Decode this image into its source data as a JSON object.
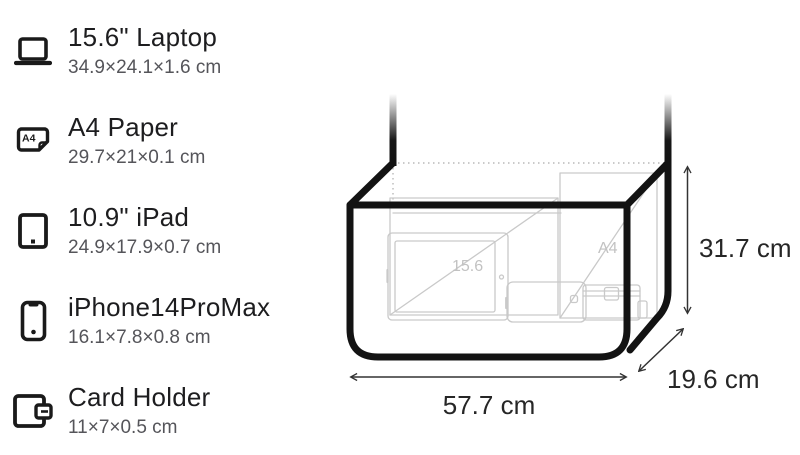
{
  "items": [
    {
      "name": "15.6\" Laptop",
      "dimensions": "34.9×24.1×1.6 cm",
      "icon": "laptop-icon"
    },
    {
      "name": "A4 Paper",
      "dimensions": "29.7×21×0.1 cm",
      "icon": "a4-paper-icon",
      "icon_label": "A4"
    },
    {
      "name": "10.9\" iPad",
      "dimensions": "24.9×17.9×0.7 cm",
      "icon": "ipad-icon"
    },
    {
      "name": "iPhone14ProMax",
      "dimensions": "16.1×7.8×0.8 cm",
      "icon": "iphone-icon"
    },
    {
      "name": "Card Holder",
      "dimensions": "11×7×0.5 cm",
      "icon": "card-holder-icon"
    }
  ],
  "diagram": {
    "width_label": "57.7 cm",
    "depth_label": "19.6 cm",
    "height_label": "31.7 cm",
    "inner_labels": {
      "laptop": "15.6",
      "a4": "A4"
    },
    "colors": {
      "bag_outline": "#131313",
      "item_outline": "#c9c9c9",
      "dimension_label": "#262626",
      "inner_label": "#c2c2c2",
      "dotted_edge": "#b9b9b9",
      "arrow": "#333333"
    }
  }
}
